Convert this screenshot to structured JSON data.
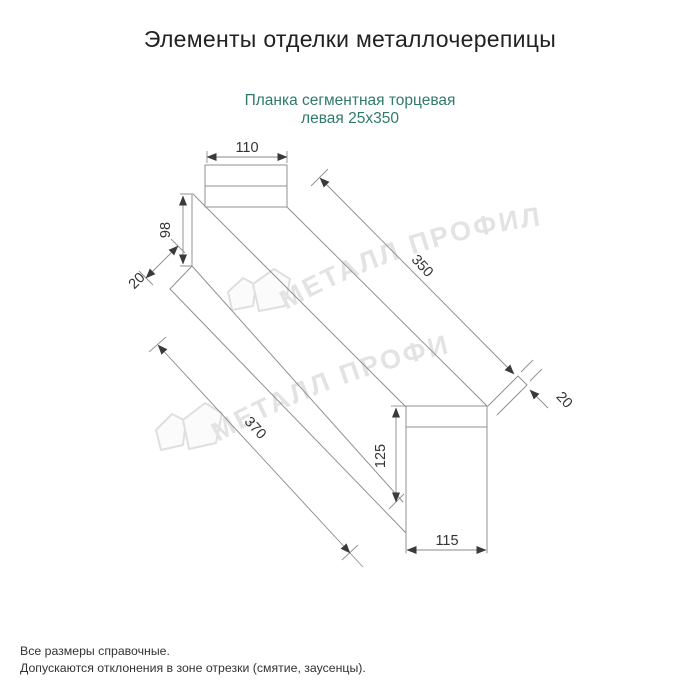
{
  "page": {
    "title": "Элементы отделки металлочерепицы",
    "subtitle": {
      "line1": "Планка сегментная торцевая",
      "line2": "левая 25х350"
    },
    "footer": {
      "line1": "Все размеры справочные.",
      "line2": "Допускаются отклонения в зоне отрезки (смятие, заусенцы)."
    }
  },
  "watermark": {
    "text": "МЕТАЛЛ ПРОФИЛЬ",
    "logo": "metall-profil-house-logo"
  },
  "drawing": {
    "type": "technical-diagram",
    "part": "Планка сегментная торцевая левая 25х350",
    "dims": {
      "top_width": "110",
      "left_height": "98",
      "left_hem": "20",
      "length_top": "350",
      "right_hem": "20",
      "length_bottom": "370",
      "end_height": "125",
      "end_width": "115"
    }
  },
  "colors": {
    "subtitle_teal": "#2f7a6b",
    "drawing_line": "#919191",
    "dim_text": "#333333",
    "watermark_gray": "#e2e2e2",
    "title_black": "#222222"
  }
}
